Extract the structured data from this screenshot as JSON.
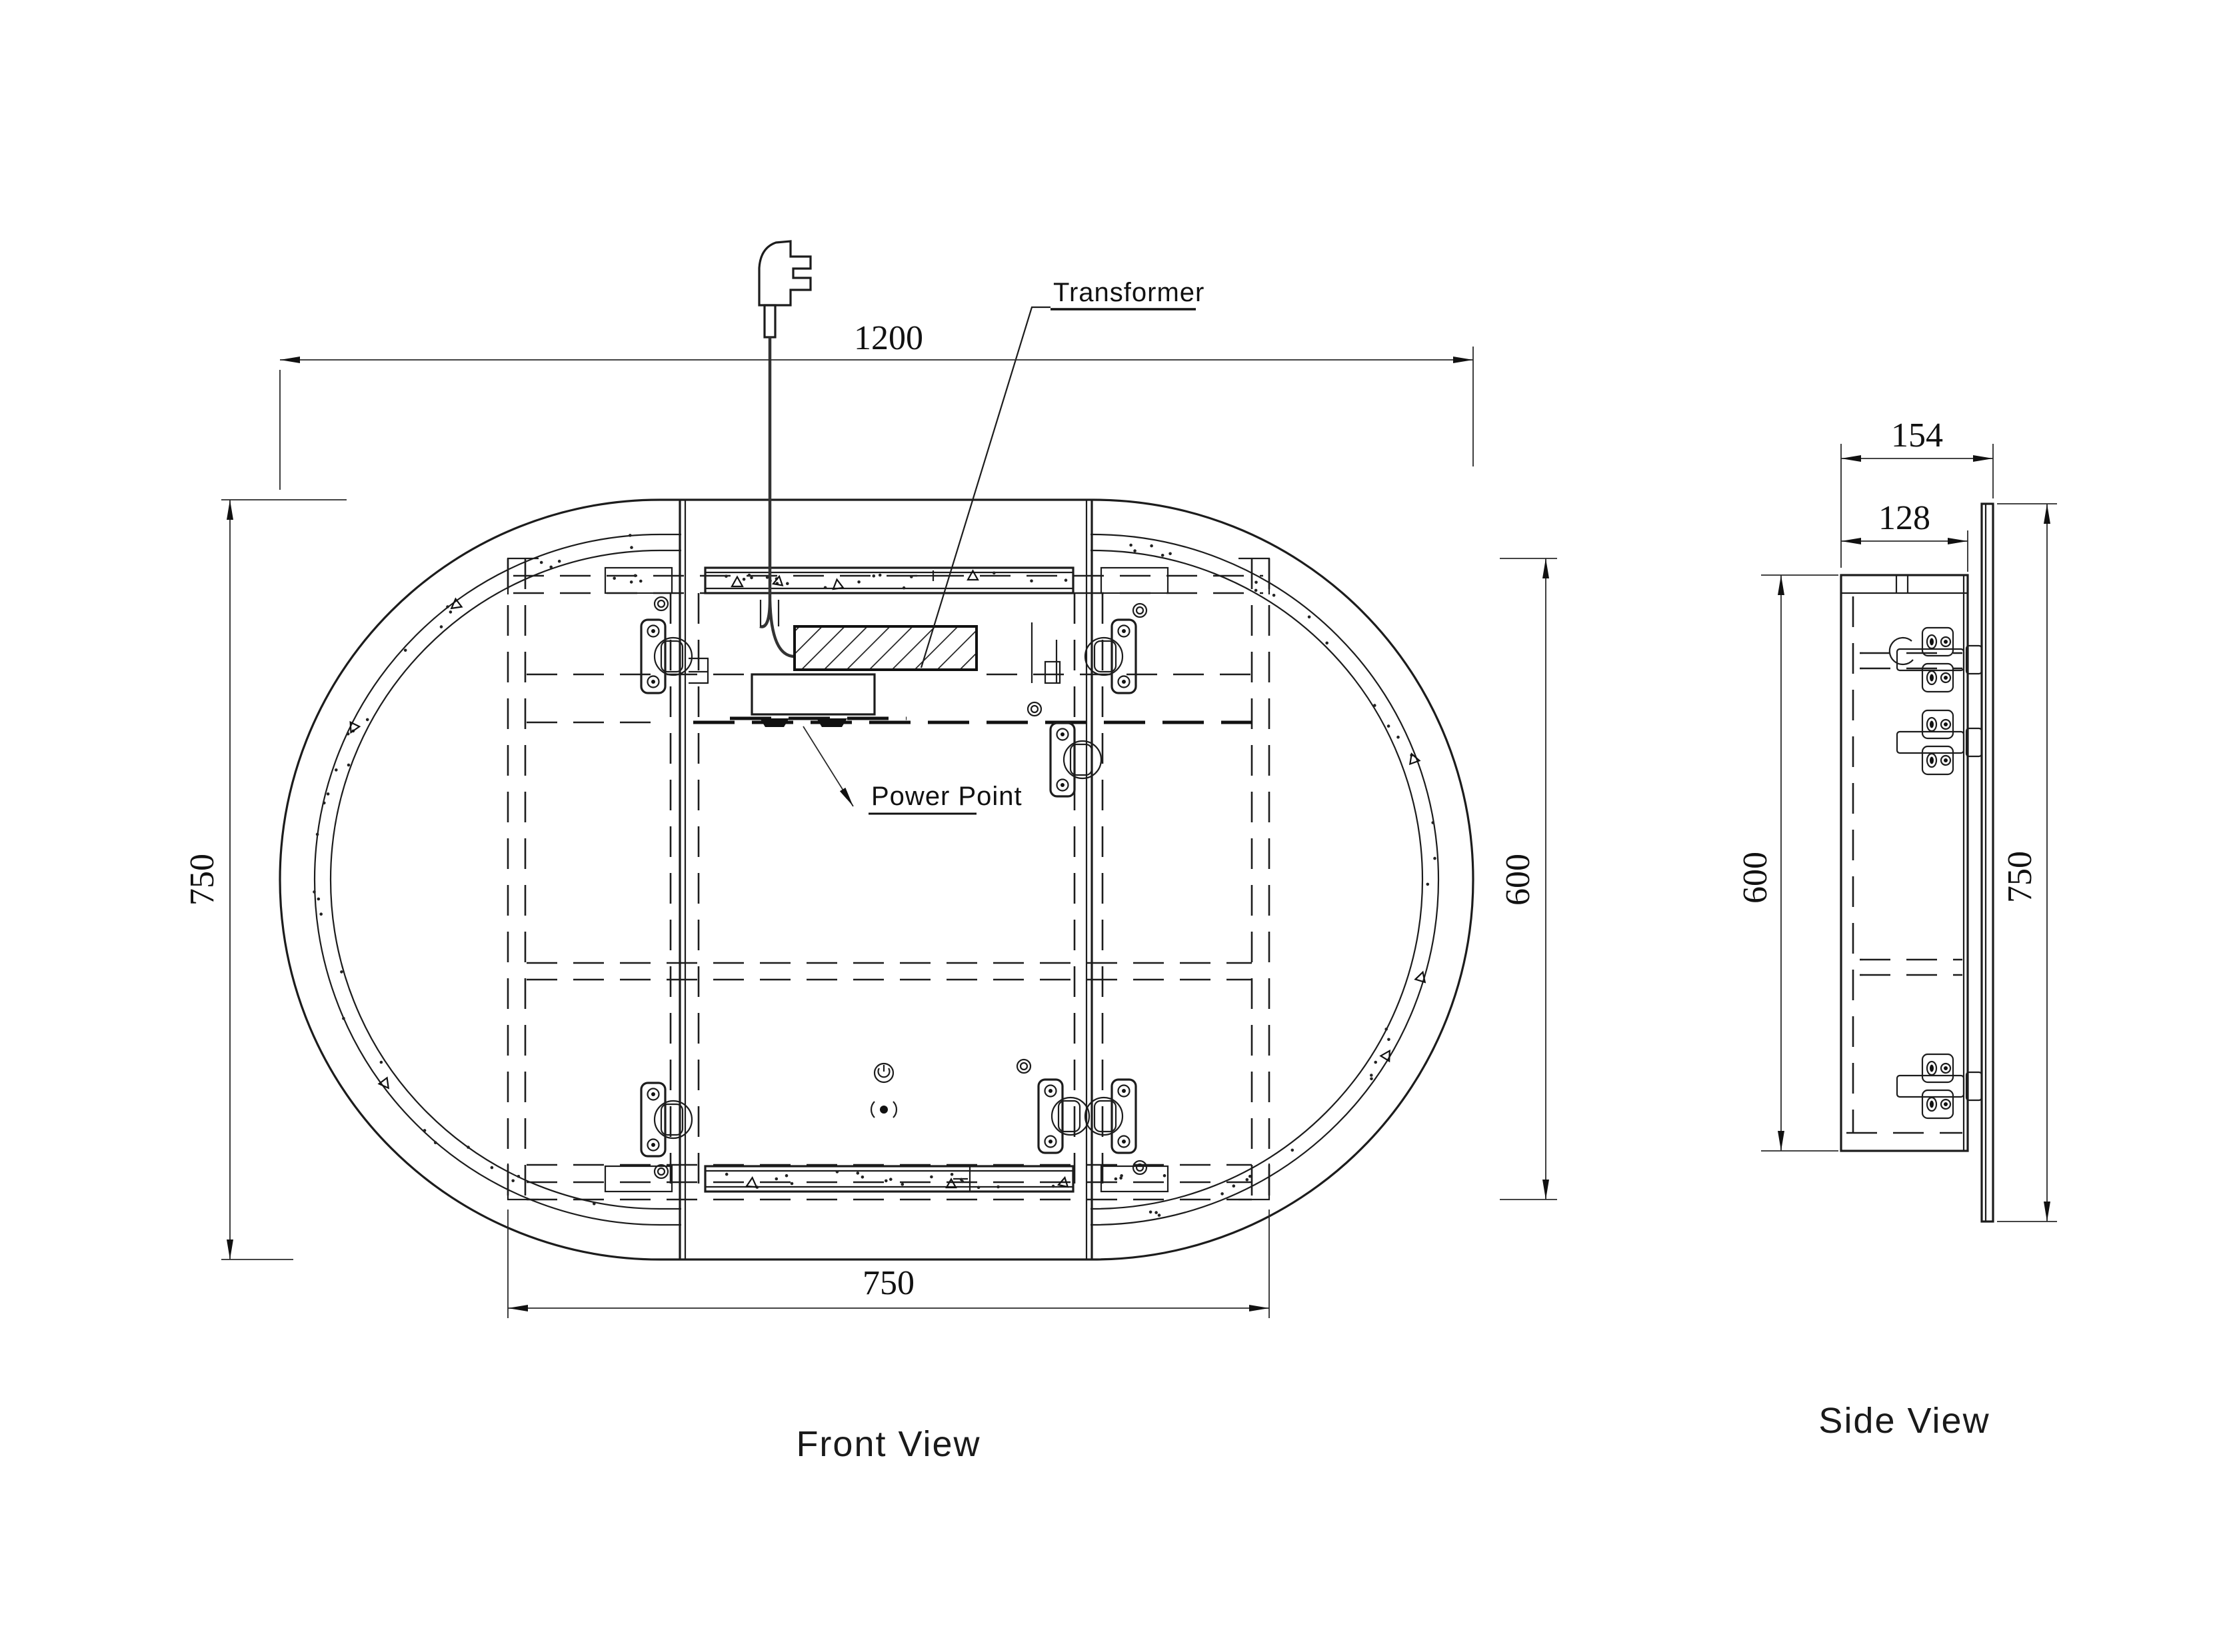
{
  "drawing_title": "Oval LED mirror cabinet drawing",
  "views": {
    "front": {
      "caption": "Front View"
    },
    "side": {
      "caption": "Side View"
    }
  },
  "labels": {
    "transformer": "Transformer",
    "power_point": "Power Point"
  },
  "dims": {
    "front_width": "1200",
    "front_height": "750",
    "front_inner_height": "600",
    "front_inner_width": "750",
    "side_depth": "154",
    "side_cabinet_depth": "128",
    "side_cabinet_height": "600",
    "side_mirror_height": "750"
  },
  "colors": {
    "line": "#1c1c1c",
    "dim": "#2a2a2a",
    "bg": "#ffffff"
  }
}
